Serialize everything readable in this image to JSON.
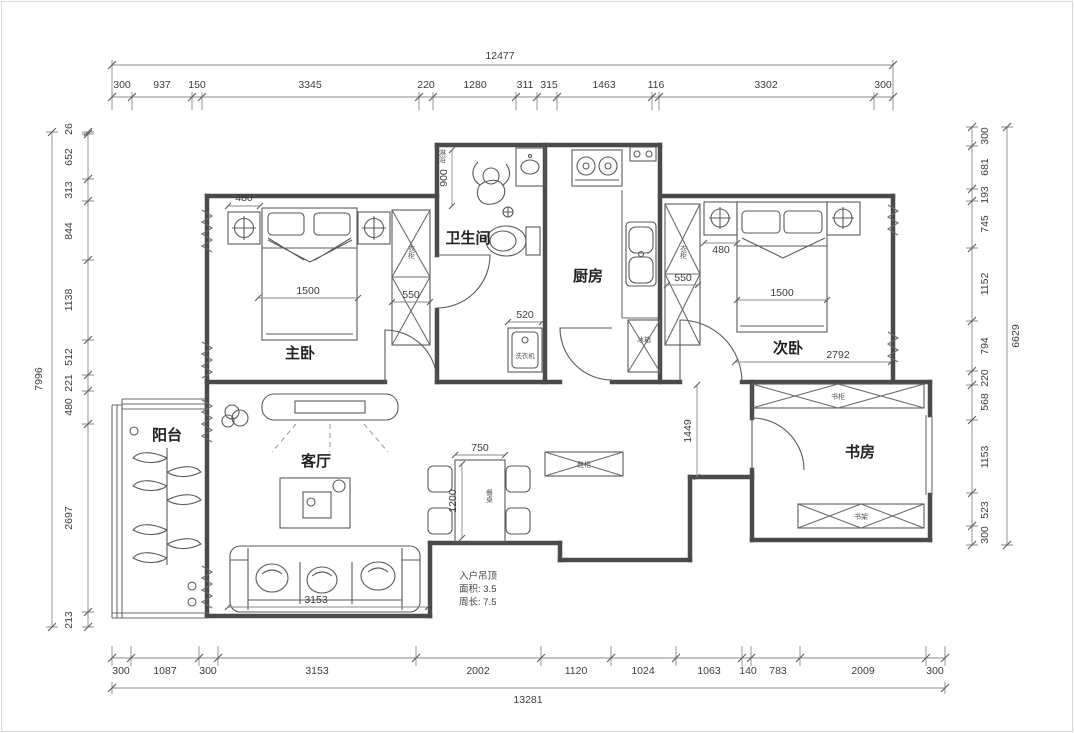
{
  "colors": {
    "background": "#ffffff",
    "wall": "#4a4a4a",
    "line": "#6b6b6b",
    "dim_text": "#3c3c3c",
    "room_text": "#222222"
  },
  "rooms": {
    "master_bedroom": "主卧",
    "bathroom": "卫生间",
    "kitchen": "厨房",
    "second_bedroom": "次卧",
    "study": "书房",
    "living_room": "客厅",
    "balcony": "阳台"
  },
  "dim_chains": {
    "top": {
      "overall": "12477",
      "segments": [
        "300",
        "937",
        "150",
        "3345",
        "220",
        "1280",
        "311",
        "315",
        "1463",
        "116",
        "3302",
        "300"
      ]
    },
    "bottom": {
      "overall": "13281",
      "segments": [
        "300",
        "1087",
        "300",
        "3153",
        "2002",
        "1120",
        "1024",
        "1063",
        "140",
        "783",
        "2009",
        "300"
      ]
    },
    "left": {
      "overall": "7996",
      "segments": [
        "26",
        "652",
        "313",
        "844",
        "1138",
        "512",
        "221",
        "480",
        "2697",
        "213"
      ]
    },
    "right": {
      "overall": "6629",
      "segments": [
        "300",
        "681",
        "193",
        "745",
        "1152",
        "794",
        "220",
        "568",
        "1153",
        "523",
        "300"
      ]
    }
  },
  "interior_dims": {
    "master_nightstand": "480",
    "master_bed": "1500",
    "master_wardrobe": "550",
    "shower_depth": "900",
    "washer_width": "520",
    "second_nightstand": "480",
    "second_bed": "1500",
    "second_wardrobe": "550",
    "second_room_width": "2792",
    "hallway": "1449",
    "table_width": "750",
    "table_length": "1200",
    "sofa_wall": "3153"
  },
  "furniture_labels": {
    "shower": "淋浴",
    "wardrobe_master": "衣柜",
    "wardrobe_second": "衣柜",
    "dining_table": "餐桌",
    "fridge": "冰箱",
    "washer": "洗衣机",
    "shoe_cabinet": "鞋柜",
    "bookcase_top": "书柜",
    "bookcase_bottom": "书架"
  },
  "entry_note": {
    "line1": "入户吊顶",
    "line2": "面积: 3.5",
    "line3": "周长: 7.5"
  }
}
